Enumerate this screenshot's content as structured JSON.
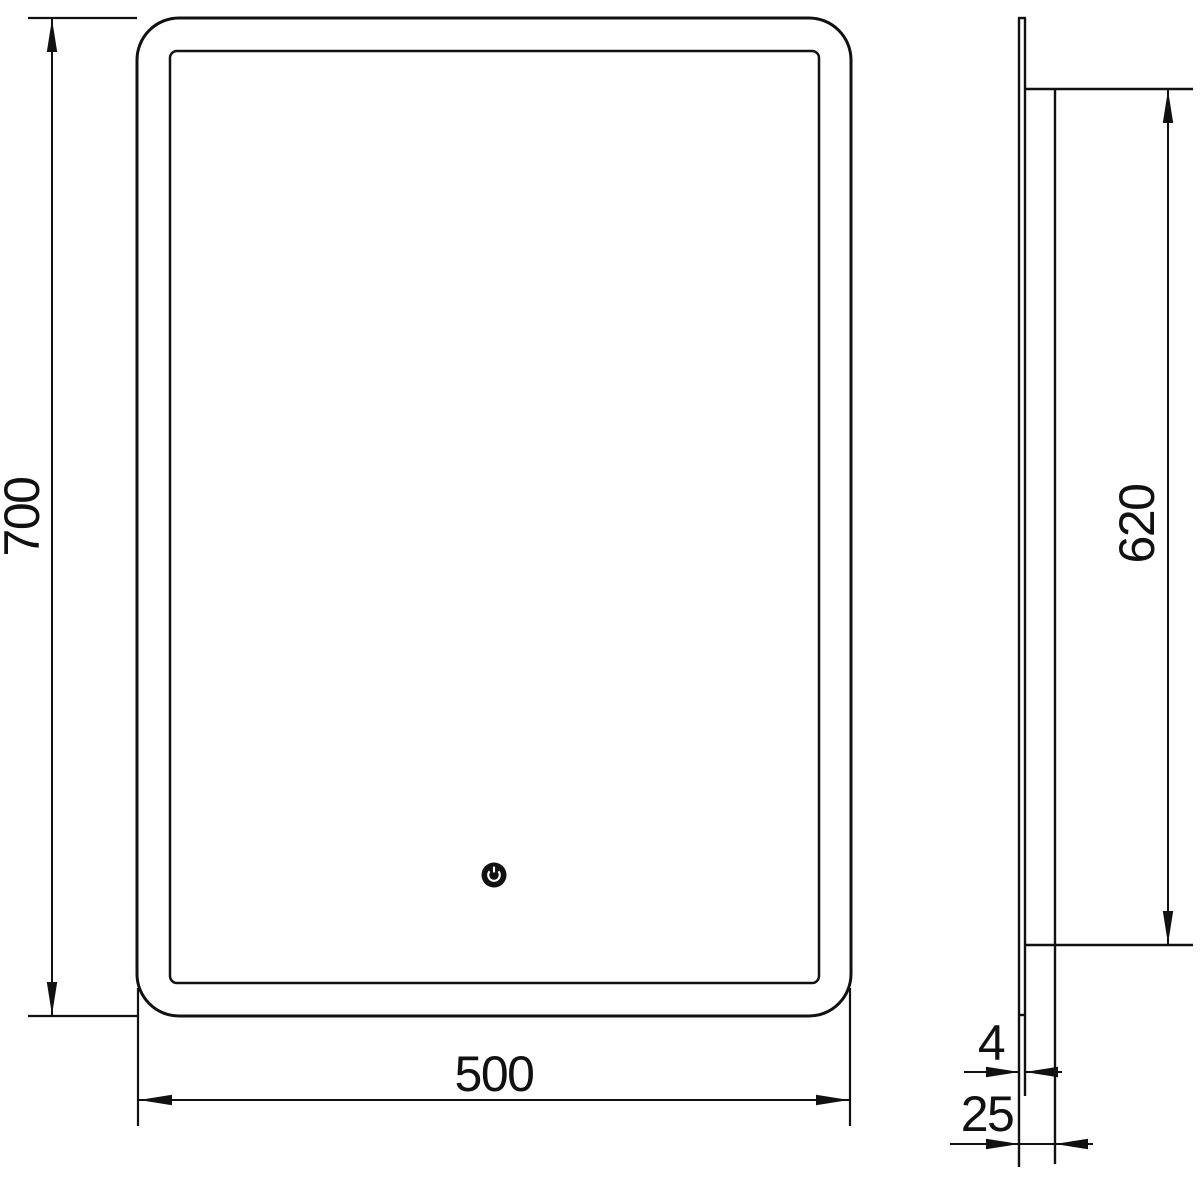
{
  "drawing": {
    "type": "technical-dimension-drawing",
    "subject": "led-mirror-with-touch-sensor",
    "colors": {
      "line": "#111111",
      "background": "#ffffff"
    },
    "front_view": {
      "height_label": "700",
      "width_label": "500",
      "touch_icon": "power-icon"
    },
    "side_view": {
      "inner_height_label": "620",
      "glass_thickness_label": "4",
      "depth_label": "25"
    }
  }
}
